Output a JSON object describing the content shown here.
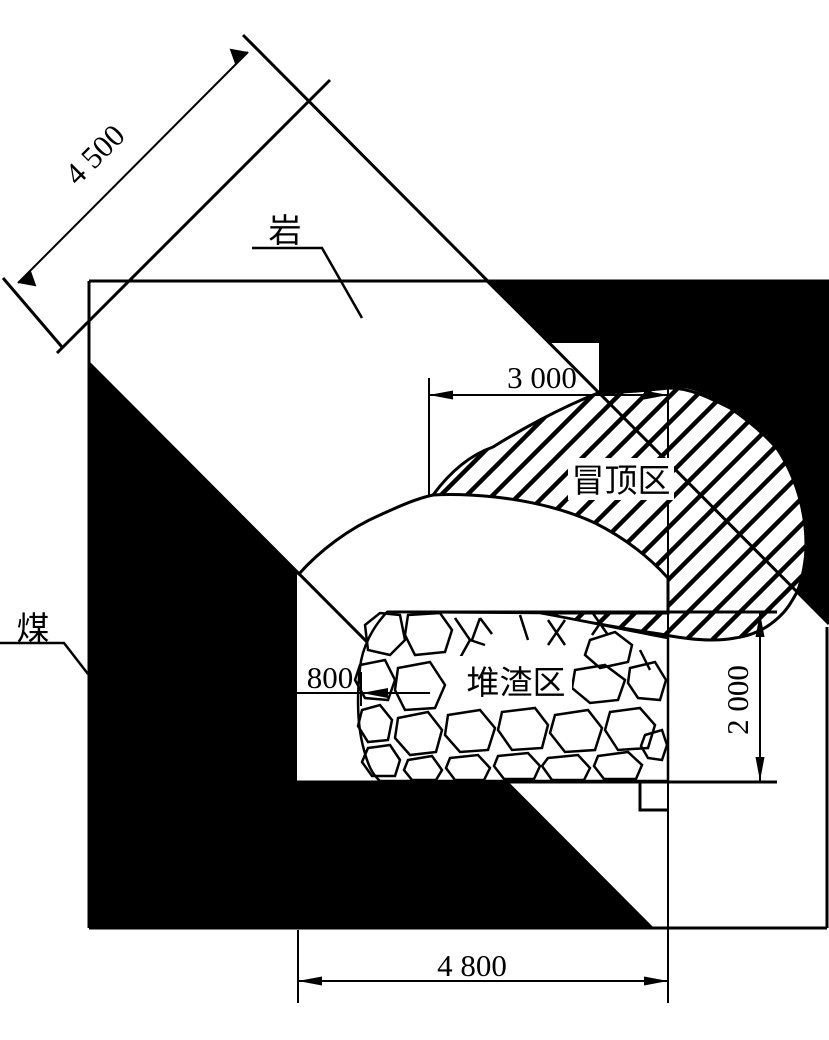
{
  "diagram": {
    "labels": {
      "rock": "岩",
      "coal": "煤",
      "roof_fall_zone": "冒顶区",
      "debris_zone": "堆渣区"
    },
    "dimensions": {
      "incline_width": "4 500",
      "roof_span": "3 000",
      "wall_gap": "800",
      "right_height": "2 000",
      "bottom_span": "4 800"
    },
    "colors": {
      "ink": "#000000",
      "paper": "#ffffff"
    }
  }
}
